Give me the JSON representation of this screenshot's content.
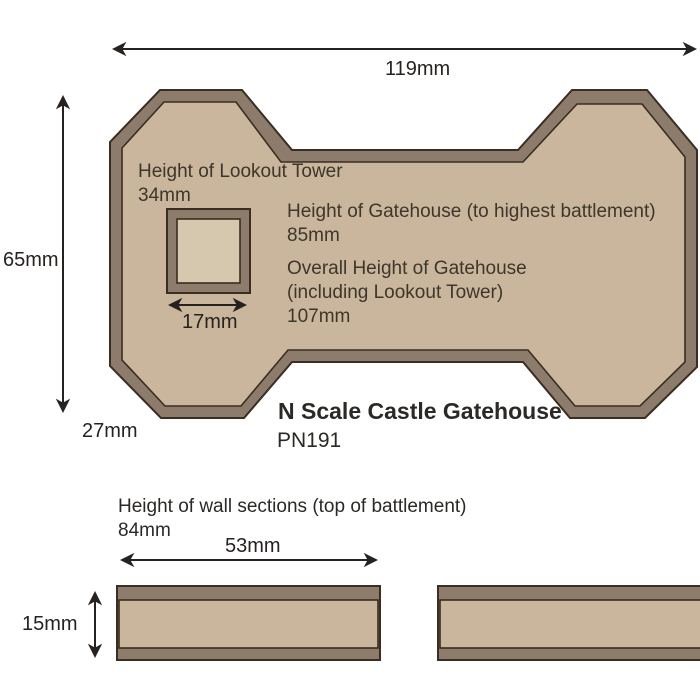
{
  "diagram": {
    "title": "N Scale Castle Gatehouse",
    "product_code": "PN191",
    "footprint": {
      "width_dim": "119mm",
      "height_dim": "65mm",
      "depth_dim": "27mm",
      "lookout_tower": {
        "label_line1": "Height of Lookout Tower",
        "label_line2": "34mm",
        "width_dim": "17mm"
      },
      "gatehouse_height": {
        "label": "Height of Gatehouse (to highest battlement)",
        "value": "85mm"
      },
      "overall_height": {
        "label_line1": "Overall Height of Gatehouse",
        "label_line2": "(including Lookout Tower)",
        "value": "107mm"
      }
    },
    "wall_sections": {
      "heading": "Height of wall sections (top of battlement)",
      "height_value": "84mm",
      "length_dim": "53mm",
      "thickness_dim": "15mm"
    },
    "colors": {
      "fill": "#cab69c",
      "band": "#8d7c6c",
      "outline": "#3a2d21",
      "tower_fill": "#d6c8ae",
      "ink": "#262220",
      "label_ink": "#3e362b"
    }
  }
}
